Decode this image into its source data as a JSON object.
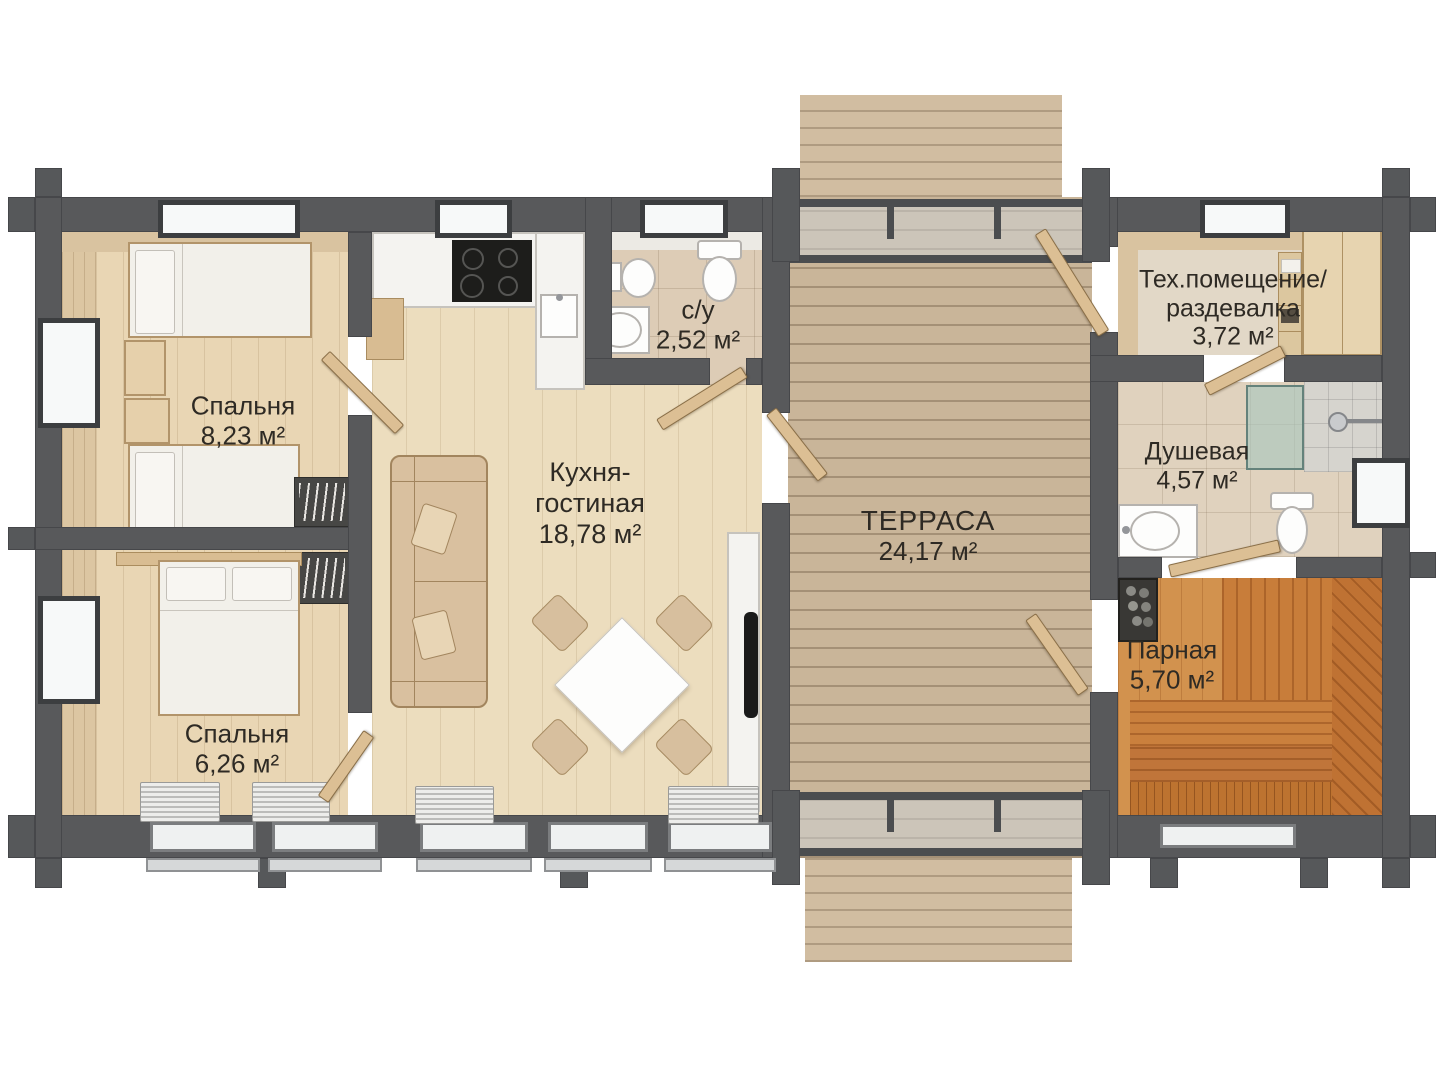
{
  "rooms": {
    "bedroom_top": {
      "name": "Спальня",
      "area": "8,23 м²"
    },
    "bedroom_bottom": {
      "name": "Спальня",
      "area": "6,26 м²"
    },
    "kitchen_living": {
      "name_line1": "Кухня-",
      "name_line2": "гостиная",
      "area": "18,78 м²"
    },
    "bathroom": {
      "name": "с/у",
      "area": "2,52 м²"
    },
    "terrace": {
      "name": "ТЕРРАСА",
      "area": "24,17 м²"
    },
    "tech_room": {
      "name_line1": "Тех.помещение/",
      "name_line2": "раздевалка",
      "area": "3,72 м²"
    },
    "shower_room": {
      "name": "Душевая",
      "area": "4,57 м²"
    },
    "sauna": {
      "name": "Парная",
      "area": "5,70 м²"
    }
  },
  "colors": {
    "wall": "#58595b",
    "wood_floor": "#ecddbe",
    "terrace_deck": "#c9b599",
    "sauna_wood": "#d2924e",
    "shower_glass": "#a8c6bf",
    "label_text": "#2e2a24"
  }
}
